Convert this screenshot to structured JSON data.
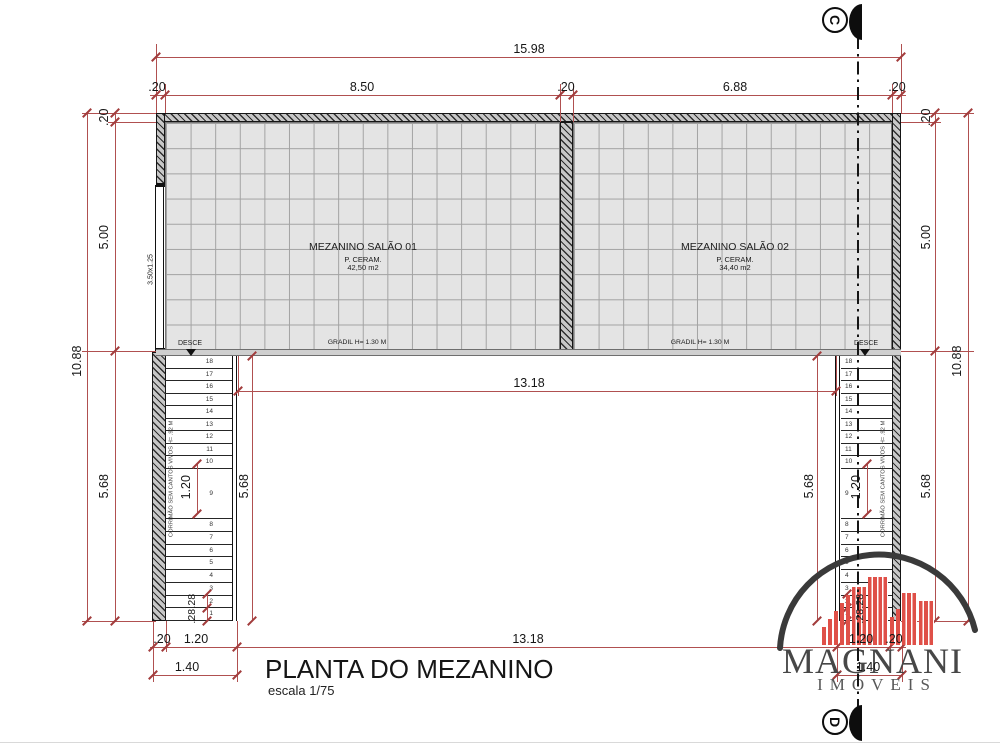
{
  "drawing": {
    "title": "PLANTA DO MEZANINO",
    "scale": "escala 1/75"
  },
  "rooms": [
    {
      "name": "MEZANINO SALÃO 01",
      "finish": "P. CERAM.",
      "area": "42,50 m2"
    },
    {
      "name": "MEZANINO SALÃO 02",
      "finish": "P. CERAM.",
      "area": "34,40 m2"
    }
  ],
  "labels": {
    "gradil": "GRADIL H= 1.30 M",
    "desce": "DESCE",
    "handrail": "CORRIMÃO SEM CANTOS VIVOS H= .92 M",
    "window_size": "3.50x1.25"
  },
  "dims": {
    "overall_width": "15.98",
    "wall": ".20",
    "span_left": "8.50",
    "span_right": "6.88",
    "overall_height": "10.88",
    "mezz_depth": "5.00",
    "stair_depth": "5.68",
    "opening_span": "13.18",
    "stair_width": "1.20",
    "landing": "1.20",
    "stair_total": "1.40",
    "tread": ".28"
  },
  "stairs": {
    "upper": [
      "18",
      "17",
      "16",
      "15",
      "14",
      "13",
      "12",
      "11",
      "10"
    ],
    "landing_step": "9",
    "lower": [
      "8",
      "7",
      "6",
      "5",
      "4",
      "3",
      "2",
      "1"
    ]
  },
  "markers": {
    "top": "C",
    "bottom": "D"
  },
  "logo": {
    "name": "MAGNANI",
    "subtitle": "IMÓVEIS"
  },
  "colors": {
    "dim_line": "#b05050",
    "wall_dark": "#1a1a1a",
    "tile_fill": "#e4e4e4",
    "logo_red": "#df5048",
    "logo_gray": "#474747"
  }
}
